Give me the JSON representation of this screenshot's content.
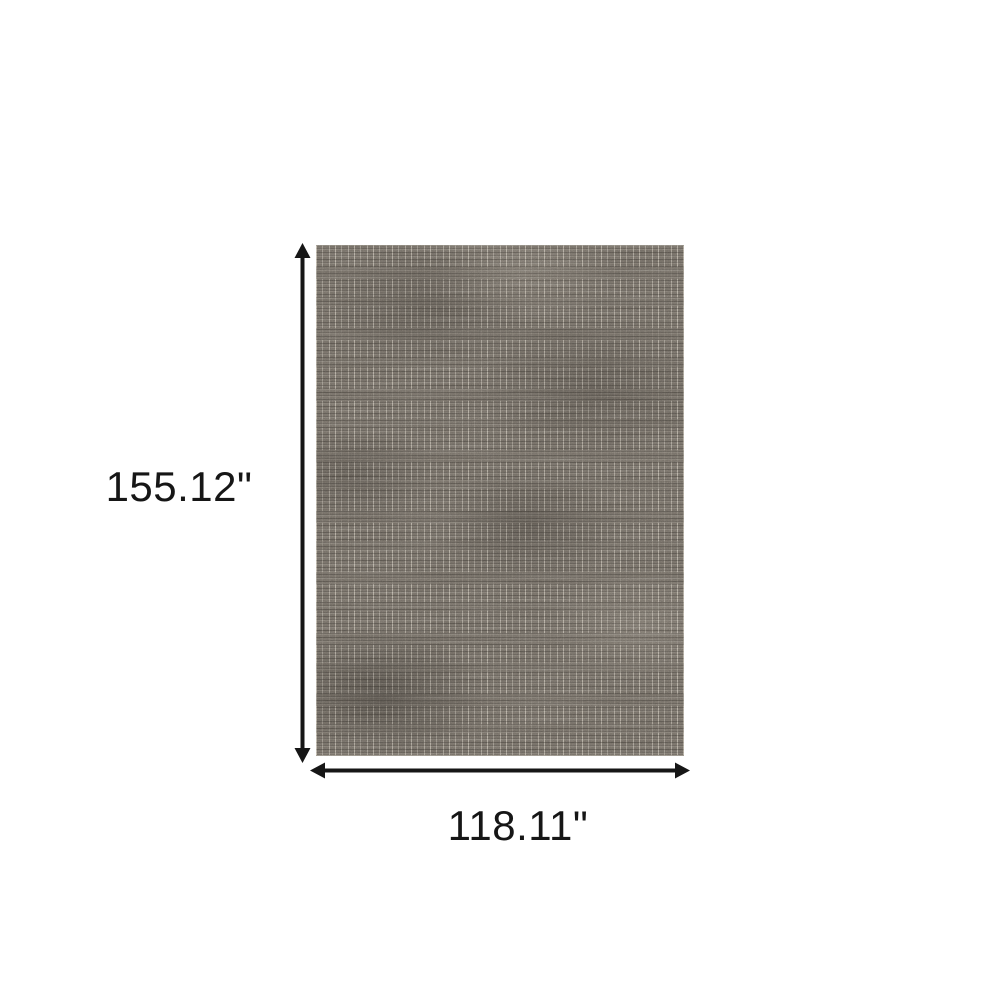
{
  "canvas": {
    "background": "#ffffff"
  },
  "dimension_labels": {
    "height": "155.12\"",
    "width": "118.11\""
  },
  "arrows": {
    "color": "#161616",
    "style": "double-headed"
  },
  "rug": {
    "description": "distressed-abstract-area-rug",
    "colors": {
      "base": "#6e6860",
      "dark_striation": "#3f3a33",
      "light_thread": "#ded6c7"
    }
  }
}
